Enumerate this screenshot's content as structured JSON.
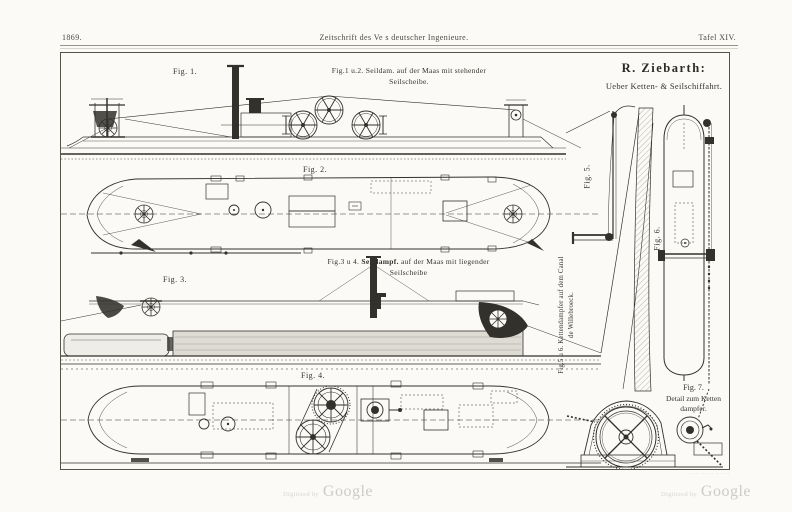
{
  "header": {
    "year": "1869.",
    "journal": "Zeitschrift des Ve s deutscher Ingenieure.",
    "plate": "Tafel XIV."
  },
  "title": {
    "author": "R. Ziebarth:",
    "subtitle": "Ueber Ketten- & Seilschiffahrt."
  },
  "figures": {
    "fig1_label": "Fig. 1.",
    "fig12_caption_1": "Fig.1 u.2. Seildam. auf der Maas mit stehender",
    "fig12_caption_2": "Seilscheibe.",
    "fig2_label": "Fig. 2.",
    "fig34_prefix": "Fig.3 u 4. ",
    "fig34_bold": "Seildampf.",
    "fig34_rest": " auf der Maas mit liegender",
    "fig34_caption_2": "Seilscheibe",
    "fig3_label": "Fig. 3.",
    "fig4_label": "Fig. 4.",
    "fig5_label": "Fig. 5.",
    "fig6_label": "Fig. 6.",
    "fig56_caption_1": "Fig.5 u 6. Kettendampfer auf dem Canal",
    "fig56_caption_2": "de Willebroeck.",
    "fig7_label": "Fig. 7.",
    "fig7_caption_1": "Detail zum Ketten",
    "fig7_caption_2": "dampfer."
  },
  "footer": {
    "imprint": "· ·· ··· ·· · ····",
    "digitized_by": "Digitized by",
    "google": "Google"
  },
  "colors": {
    "ink": "#33312c",
    "paper": "#fbfaf7",
    "watermark": "#cdcdcb"
  }
}
